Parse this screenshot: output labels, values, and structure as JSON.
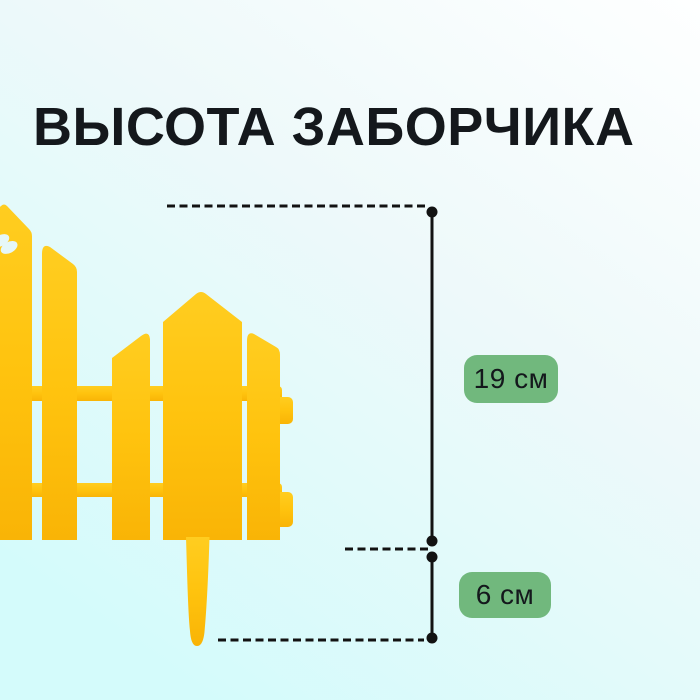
{
  "title": "ВЫСОТА ЗАБОРЧИКА",
  "measurements": [
    {
      "name": "fence-panel-height",
      "label": "19 см"
    },
    {
      "name": "ground-stake-height",
      "label": "6 см"
    }
  ],
  "illustration": {
    "subject": "yellow plastic decorative garden picket fence, partial left view with ground stake",
    "cutout_icon": "butterfly-cutout"
  },
  "colors": {
    "background_top": "#feffff",
    "background_bottom": "#d4fbfb",
    "fence_yellow": "#ffc30e",
    "fence_yellow_deep": "#f9b406",
    "fence_yellow_light": "#ffcd20",
    "badge_green": "#71b87d",
    "annotation_black": "#121212",
    "title_color": "#14181c"
  }
}
